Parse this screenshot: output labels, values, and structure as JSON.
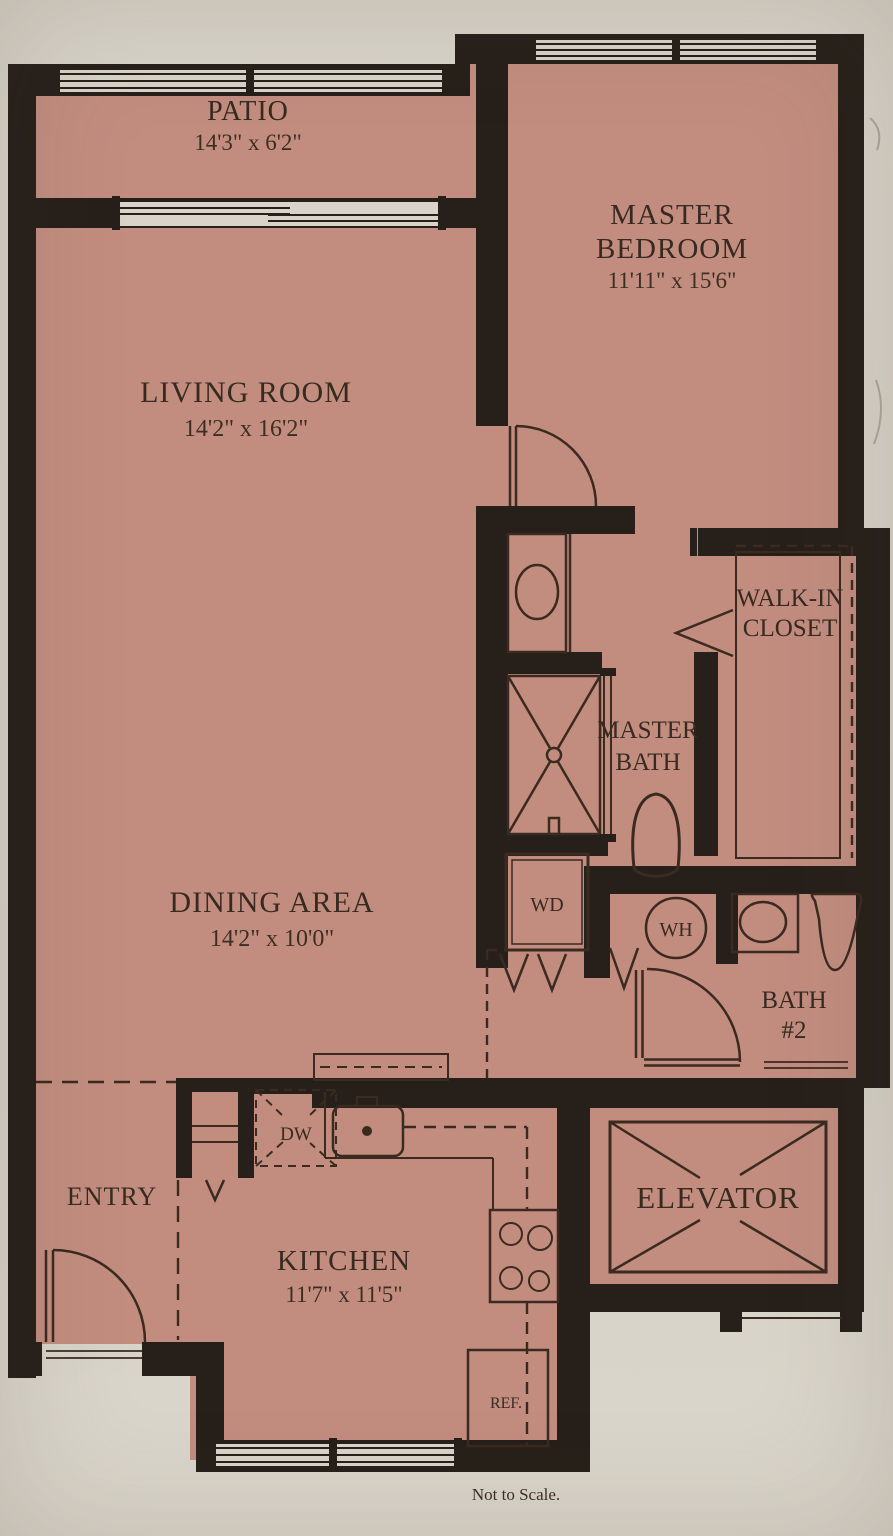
{
  "document": {
    "type": "apartment floor plan",
    "footer_note": "Not to Scale."
  },
  "palette": {
    "paper": "#d8d4c9",
    "room_fill": "#c28d7f",
    "wall": "#27201a",
    "line": "#3a2a1f",
    "text": "#372a20"
  },
  "rooms": {
    "patio": {
      "name": "PATIO",
      "dimensions": "14'3\" x 6'2\""
    },
    "living_room": {
      "name": "LIVING ROOM",
      "dimensions": "14'2\" x 16'2\""
    },
    "master_bedroom": {
      "name_line1": "MASTER",
      "name_line2": "BEDROOM",
      "dimensions": "11'11\" x 15'6\""
    },
    "dining_area": {
      "name": "DINING AREA",
      "dimensions": "14'2\" x 10'0\""
    },
    "walk_in_closet": {
      "name_line1": "WALK-IN",
      "name_line2": "CLOSET"
    },
    "master_bath": {
      "name_line1": "MASTER",
      "name_line2": "BATH"
    },
    "bath_2": {
      "name_line1": "BATH",
      "name_line2": "#2"
    },
    "entry": {
      "name": "ENTRY"
    },
    "kitchen": {
      "name": "KITCHEN",
      "dimensions": "11'7\" x 11'5\""
    },
    "elevator": {
      "name": "ELEVATOR"
    }
  },
  "appliances": {
    "washer_dryer": "WD",
    "water_heater": "WH",
    "dishwasher": "DW",
    "refrigerator": "REF."
  }
}
